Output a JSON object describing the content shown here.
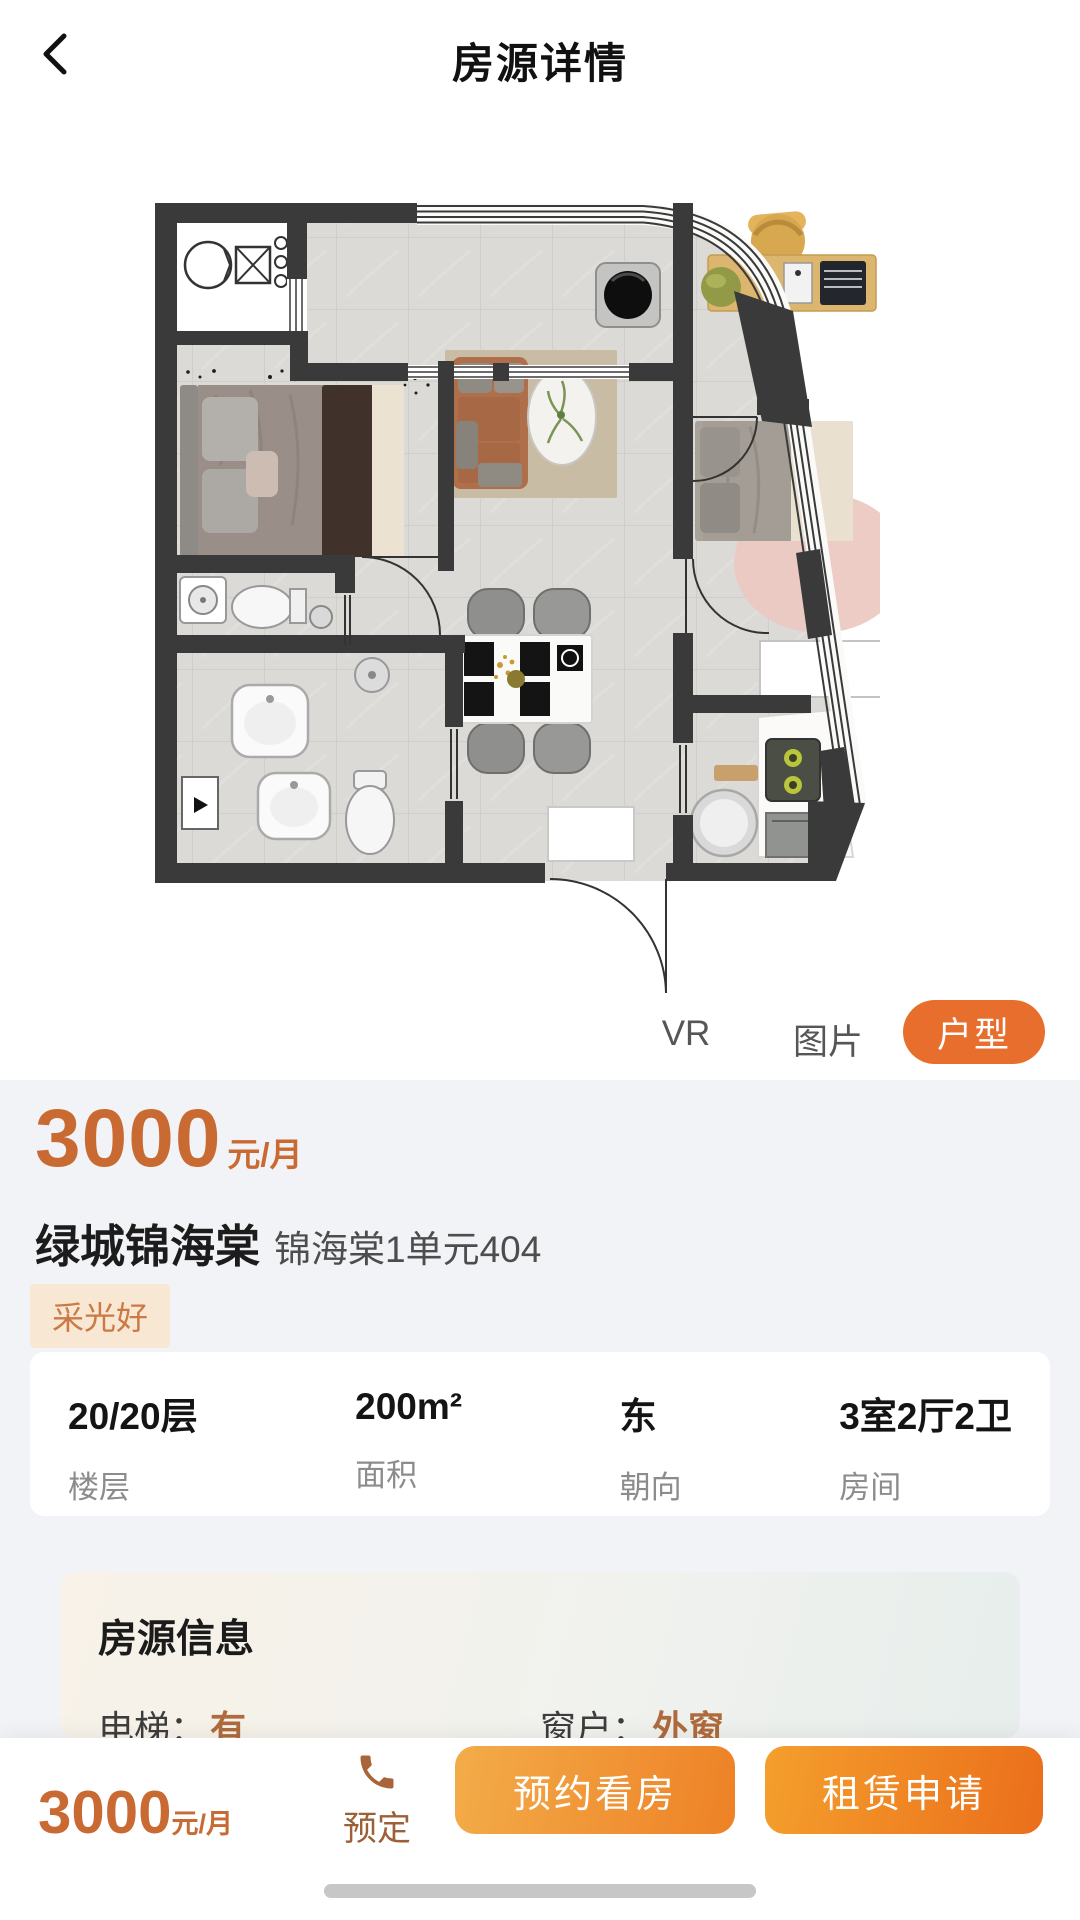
{
  "header": {
    "title": "房源详情"
  },
  "media_tabs": [
    {
      "label": "VR",
      "active": false
    },
    {
      "label": "图片",
      "active": false
    },
    {
      "label": "户型",
      "active": true
    }
  ],
  "listing": {
    "price": "3000",
    "price_unit": "元/月",
    "name": "绿城锦海棠",
    "unit_name": "锦海棠1单元404",
    "tags": [
      "采光好"
    ],
    "stats": [
      {
        "value": "20/20层",
        "label": "楼层"
      },
      {
        "value": "200m²",
        "label": "面积"
      },
      {
        "value": "东",
        "label": "朝向"
      },
      {
        "value": "3室2厅2卫",
        "label": "房间"
      }
    ]
  },
  "info_card": {
    "title": "房源信息",
    "rows": [
      {
        "label": "电梯：",
        "value": "有"
      },
      {
        "label": "窗户：",
        "value": "外窗"
      }
    ]
  },
  "bottom_bar": {
    "price": "3000",
    "price_unit": "元/月",
    "reserve_label": "预定",
    "book_label": "预约看房",
    "apply_label": "租赁申请"
  },
  "floorplan": {
    "description": "3室2厅2卫户型平面图"
  },
  "colors": {
    "accent": "#E86E2E",
    "price_orange": "#C96A33",
    "tag_bg": "#F8E7D2",
    "tag_text": "#CB7A45",
    "value_orange": "#AE6B3D",
    "section_bg": "#F1F3F6",
    "button_gradient_start": "#F4A83F",
    "button_gradient_end": "#EC751F"
  }
}
